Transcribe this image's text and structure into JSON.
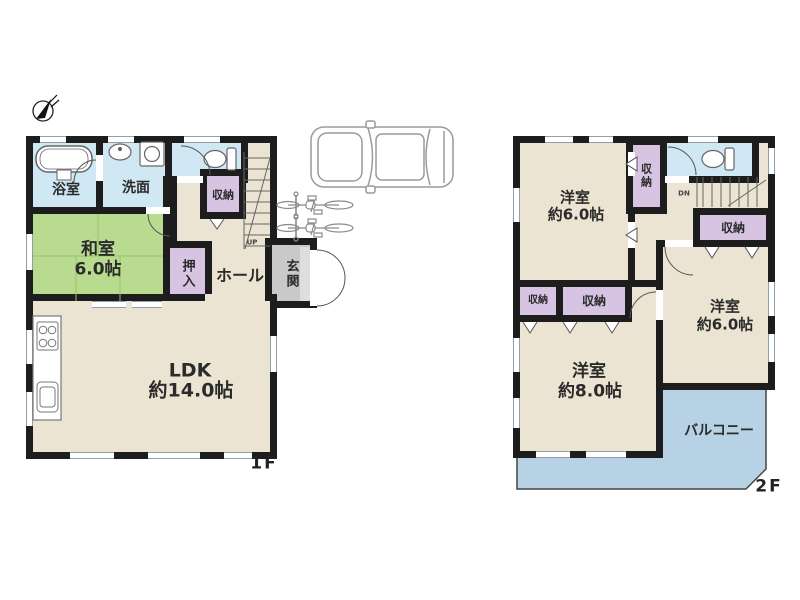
{
  "palette": {
    "wall": "#1d1d1d",
    "room_beige": "#ece4d2",
    "tatami_green": "#b9db90",
    "water_blue": "#cfe8f3",
    "closet_purple": "#d6c4e2",
    "entry_gray": "#c9c9c9",
    "balcony_blue": "#b7d2e4",
    "outline_gray": "#999999"
  },
  "floor1": {
    "floor_label": "1F",
    "bath_label": "浴室",
    "washroom_label": "洗面",
    "storage_label": "収納",
    "washitsu_label": "和室",
    "washitsu_size": "6.0帖",
    "oshiire_label": "押入",
    "hall_label": "ホール",
    "entrance_label": "玄関",
    "stairs_label": "UP",
    "ldk_label": "LDK",
    "ldk_size": "約14.0帖"
  },
  "floor2": {
    "floor_label": "2F",
    "bedroom_nw_label": "洋室",
    "bedroom_nw_size": "約6.0帖",
    "bedroom_east_label": "洋室",
    "bedroom_east_size": "約6.0帖",
    "bedroom_south_label": "洋室",
    "bedroom_south_size": "約8.0帖",
    "storage_label": "収納",
    "stairs_label": "DN",
    "balcony_label": "バルコニー"
  }
}
